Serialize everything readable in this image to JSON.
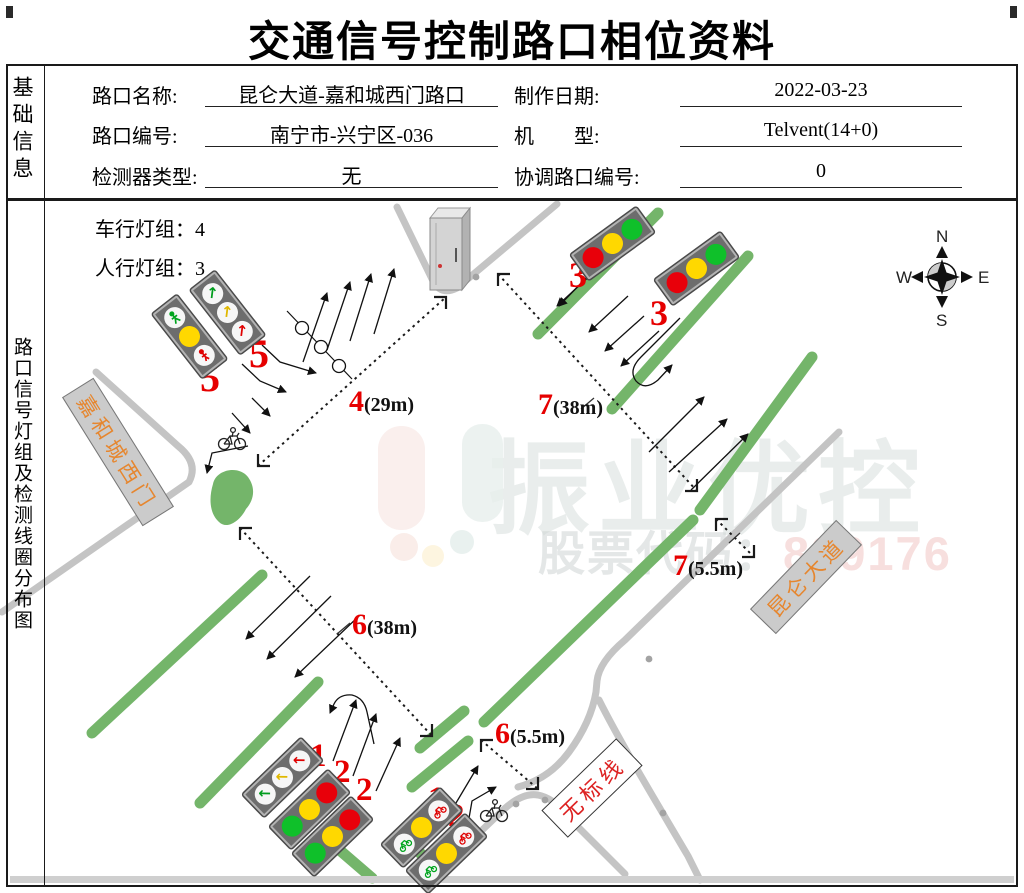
{
  "header": {
    "title": "交通信号控制路口相位资料"
  },
  "basic_info": {
    "section_label": "基础信息",
    "fields": [
      {
        "label": "路口名称:",
        "value": "昆仑大道-嘉和城西门路口"
      },
      {
        "label": "路口编号:",
        "value": "南宁市-兴宁区-036"
      },
      {
        "label": "检测器类型:",
        "value": "无"
      },
      {
        "label": "制作日期:",
        "value": "2022-03-23"
      },
      {
        "label": "机　　型:",
        "value": "Telvent(14+0)"
      },
      {
        "label": "协调路口编号:",
        "value": "0"
      }
    ]
  },
  "diagram": {
    "section_label": "路口信号灯组及检测线圈分布图",
    "vehicle_light_groups": {
      "label": "车行灯组：",
      "value": "4"
    },
    "ped_light_groups": {
      "label": "人行灯组：",
      "value": "3"
    },
    "compass": {
      "n": "N",
      "s": "S",
      "e": "E",
      "w": "W"
    },
    "road_signs": [
      {
        "name": "嘉和城西门"
      },
      {
        "name": "昆仑大道"
      },
      {
        "name": "无标线"
      }
    ],
    "distance_labels": [
      {
        "num": "4",
        "dist": "(29m)"
      },
      {
        "num": "7",
        "dist": "(38m)"
      },
      {
        "num": "6",
        "dist": "(38m)"
      },
      {
        "num": "7",
        "dist": "(5.5m)"
      },
      {
        "num": "6",
        "dist": "(5.5m)"
      }
    ],
    "phase_markers": [
      "5",
      "5",
      "3",
      "3",
      "1",
      "2",
      "2",
      "1",
      "2"
    ]
  },
  "watermark": {
    "brand": "振业优控",
    "stock_label": "股票代码：",
    "stock_code": "839176"
  },
  "colors": {
    "median_green": "#74b56a",
    "road_grey": "#c4c4c4",
    "marker_red": "#e60000",
    "sign_text_orange": "#e6862e",
    "sign_text_red": "#dd2222"
  }
}
